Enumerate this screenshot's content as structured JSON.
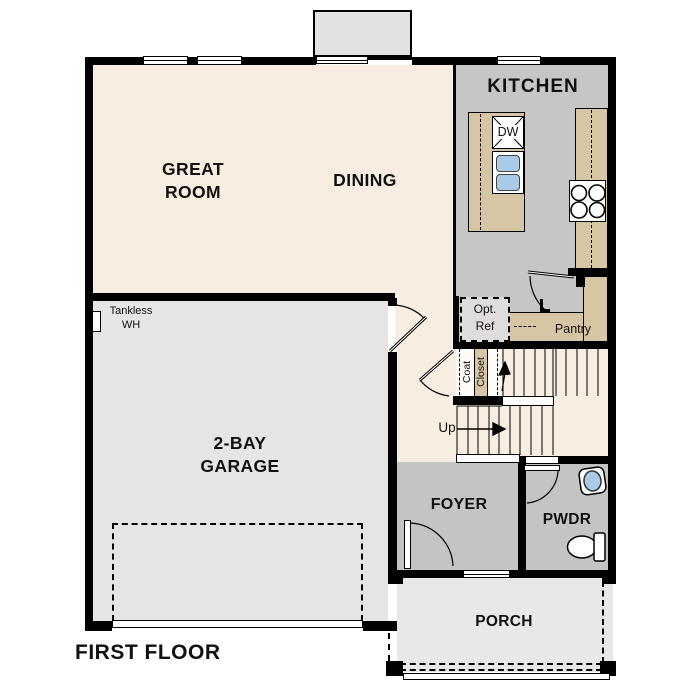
{
  "plan": {
    "title": "FIRST FLOOR",
    "rooms": {
      "great_room": {
        "line1": "GREAT",
        "line2": "ROOM"
      },
      "dining": {
        "label": "DINING"
      },
      "kitchen": {
        "label": "KITCHEN"
      },
      "garage": {
        "line1": "2-BAY",
        "line2": "GARAGE"
      },
      "foyer": {
        "label": "FOYER"
      },
      "powder": {
        "label": "PWDR"
      },
      "porch": {
        "label": "PORCH"
      },
      "pantry": {
        "label": "Pantry"
      }
    },
    "annotations": {
      "opt_ref": {
        "line1": "Opt.",
        "line2": "Ref"
      },
      "tankless": {
        "line1": "Tankless",
        "line2": "WH"
      },
      "coat": "Coat",
      "closet": "Closet",
      "up": "Up",
      "dishwasher": "DW"
    },
    "colors": {
      "wall": "#000000",
      "living_floor": "#f7eee1",
      "kitchen_floor": "#c6c6c4",
      "foyer_floor": "#c4c4c2",
      "garage_floor": "#e5e5e3",
      "porch_floor": "#e8e8e6",
      "counter": "#d7c6a4",
      "sink_blue": "#a9cbe8",
      "opt_ref_fill": "#dedddb"
    }
  }
}
